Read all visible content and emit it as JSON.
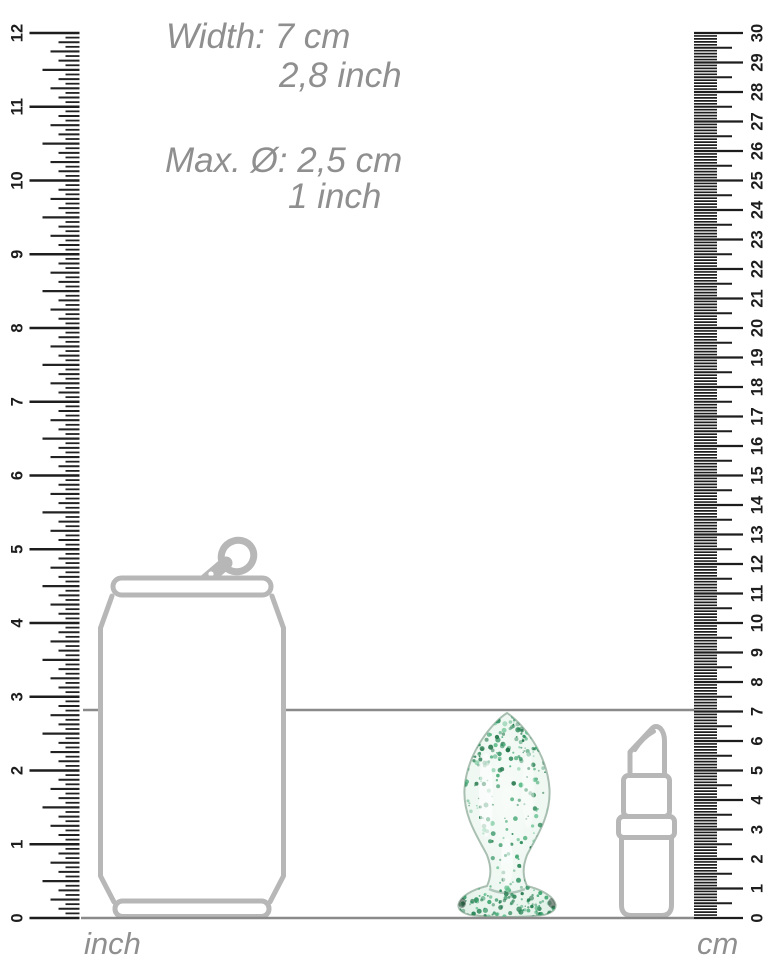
{
  "annotations": {
    "width_line1": "Width: 7 cm",
    "width_line2": "2,8 inch",
    "diameter_line1": "Max. Ø: 2,5 cm",
    "diameter_line2": "1 inch"
  },
  "measurements": {
    "height_cm": 7,
    "height_inch": 2.8,
    "max_diameter_cm": 2.5,
    "max_diameter_inch": 1
  },
  "rulers": {
    "inch": {
      "unit_label": "inch",
      "min": 0,
      "max": 12,
      "subdivisions_per_unit": 16,
      "numbers": [
        "0",
        "1",
        "2",
        "3",
        "4",
        "5",
        "6",
        "7",
        "8",
        "9",
        "10",
        "11",
        "12"
      ]
    },
    "cm": {
      "unit_label": "cm",
      "min": 0,
      "max": 30,
      "subdivisions_per_unit": 10,
      "numbers": [
        "0",
        "1",
        "2",
        "3",
        "4",
        "5",
        "6",
        "7",
        "8",
        "9",
        "10",
        "11",
        "12",
        "13",
        "14",
        "15",
        "16",
        "17",
        "18",
        "19",
        "20",
        "21",
        "22",
        "23",
        "24",
        "25",
        "26",
        "27",
        "28",
        "29",
        "30"
      ]
    }
  },
  "objects": {
    "product": "glitter-glass-plug",
    "comparison_left": "soda-can-outline",
    "comparison_right": "lipstick-outline"
  },
  "colors": {
    "outline_gray": "#b7b7b7",
    "annotation_gray": "#8f8f8f",
    "tick_black": "#1d1d1d",
    "guide_line_gray": "#8a8a8a",
    "speckle_green_dark": "#1e7347",
    "speckle_green_mid": "#2e9160",
    "speckle_green_light": "#5cbd8a",
    "glass_tint": "#e9f5ee"
  }
}
